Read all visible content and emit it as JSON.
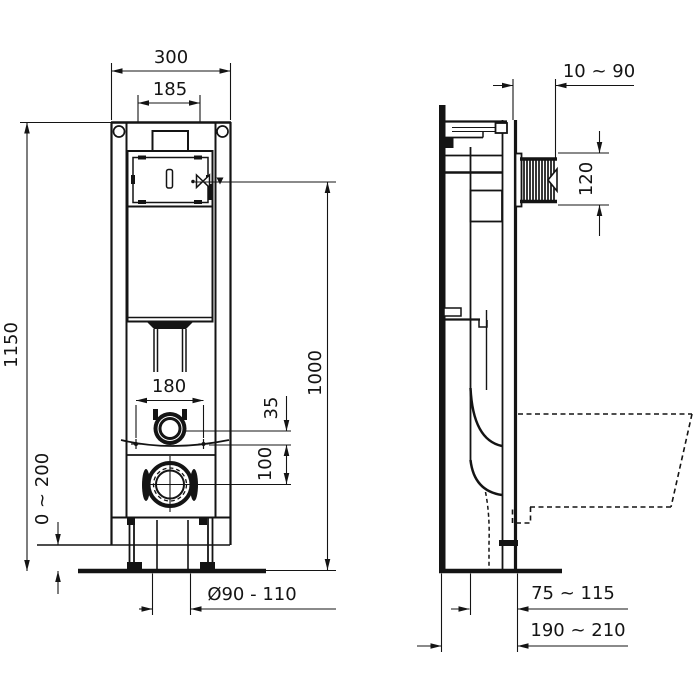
{
  "drawing": {
    "colors": {
      "ink": "#141414",
      "background": "#ffffff"
    },
    "views": {
      "front": {
        "dimensions": {
          "overall_width": "300",
          "tank_width": "185",
          "overall_height": "1150",
          "flush_line_height": "1000",
          "fixing_bolt_spacing": "180",
          "flush_pipe_offset": "35",
          "drain_offset": "100",
          "leg_adjustment": "0 ~ 200",
          "drain_diameter": "Ø90 - 110"
        }
      },
      "side": {
        "dimensions": {
          "wall_clearance": "10 ~ 90",
          "flush_bend_height": "120",
          "drain_center_to_front": "75 ~ 115",
          "frame_depth": "190 ~ 210"
        }
      }
    }
  }
}
